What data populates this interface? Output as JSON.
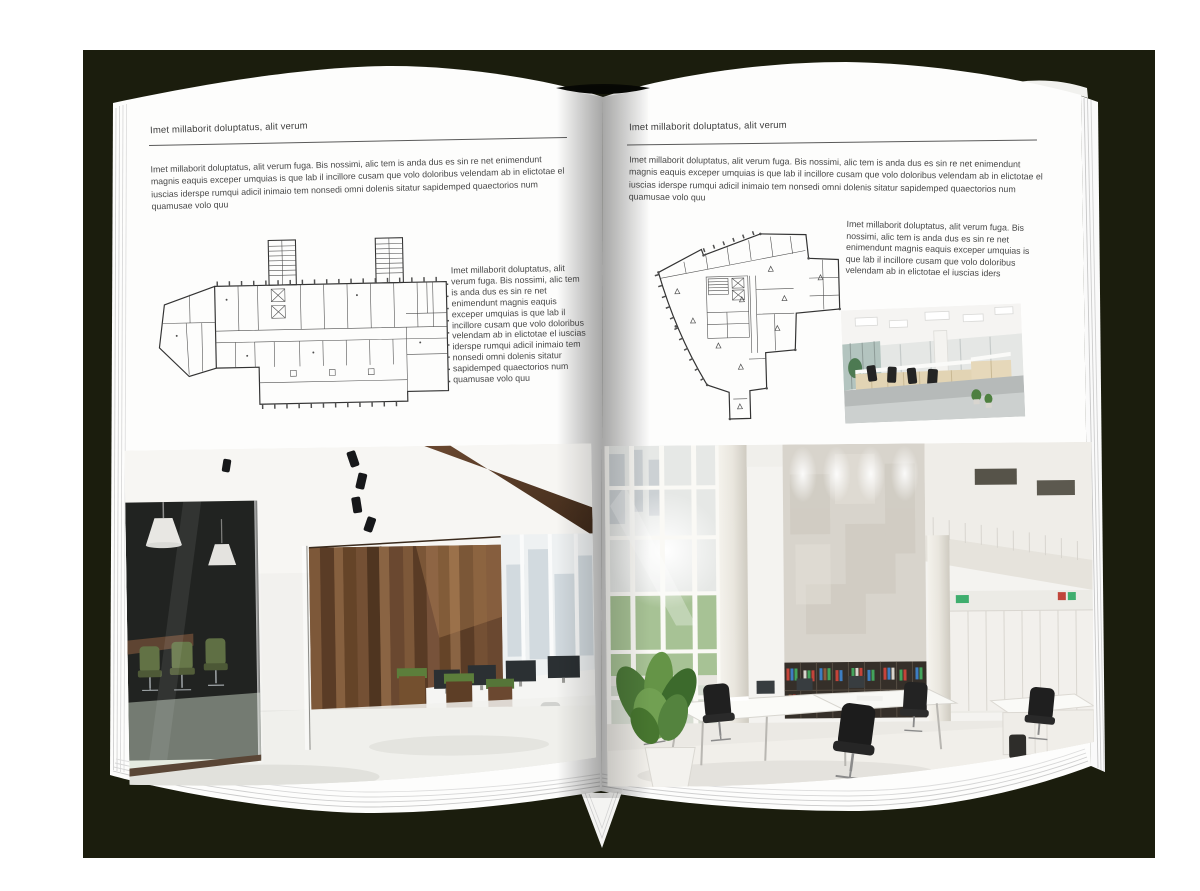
{
  "book": {
    "left_page": {
      "header": "Imet millaborit doluptatus, alit verum",
      "intro": "Imet millaborit doluptatus, alit verum fuga. Bis nossimi, alic tem is anda dus es sin re net enimendunt magnis eaquis exceper umquias is que lab il incillore cusam que volo doloribus velendam ab in elictotae el iuscias iderspe rumqui adicil inimaio tem nonsedi omni dolenis sitatur sapidemped quaectorios num quamusae volo quu",
      "side_text": "Imet millaborit doluptatus, alit verum fuga. Bis nossimi, alic tem is anda dus es sin re net enimendunt magnis eaquis exceper umquias is que lab il incillore cusam que volo doloribus velendam ab in elictotae el iuscias iderspe rumqui adicil inimaio tem nonsedi omni dolenis sitatur sapidemped quaectorios num quamusae volo quu"
    },
    "right_page": {
      "header": "Imet millaborit doluptatus, alit verum",
      "intro": "Imet millaborit doluptatus, alit verum fuga. Bis nossimi, alic tem is anda dus es sin re net enimendunt magnis eaquis exceper umquias is que lab il incillore cusam que volo doloribus velendam ab in elictotae el iuscias iderspe rumqui adicil inimaio tem nonsedi omni dolenis sitatur sapidemped quaectorios num quamusae volo quu",
      "body_text": "Imet millaborit doluptatus, alit verum fuga. Bis nossimi, alic tem is anda dus es sin re net enimendunt magnis eaquis exceper umquias is que lab il incillore cusam que volo doloribus velendam ab in elictotae el iuscias iders"
    }
  },
  "colors": {
    "backdrop": "#1b1d0d",
    "page": "#fdfdfc",
    "text": "#474747",
    "rule": "#5a5a5a",
    "plan_line": "#4f4f4f",
    "wood": "#6f4c32",
    "chair_green": "#5a6b3c",
    "plant_green": "#53803d"
  }
}
